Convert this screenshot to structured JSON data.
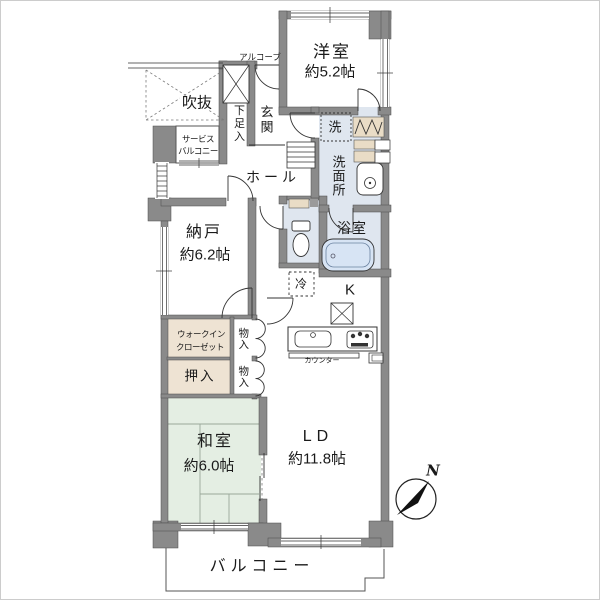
{
  "colors": {
    "wall": "#8a8a8a",
    "wet_floor": "#dfe6ef",
    "tatami": "#e4eee3",
    "closet": "#eee3d3",
    "shelf": "#e9dcc6",
    "bathtub": "#d7e4f4",
    "line": "#333333"
  },
  "labels": {
    "western_room": "洋室",
    "western_room_size": "約5.2帖",
    "alcove": "アルコーブ",
    "void": "吹抜",
    "service_balcony_line1": "サービス",
    "service_balcony_line2": "バルコニー",
    "shoe_cabinet": "下足入",
    "entrance": "玄関",
    "hall": "ホール",
    "laundry": "洗",
    "washroom": "洗面所",
    "bathroom": "浴室",
    "storage_room": "納戸",
    "storage_room_size": "約6.2帖",
    "refrigerator": "冷",
    "kitchen": "K",
    "counter": "カウンター",
    "walk_in_closet_line1": "ウォークイン",
    "walk_in_closet_line2": "クローゼット",
    "storage_upper": "物入",
    "storage_lower": "物入",
    "oshiire": "押入",
    "japanese_room": "和室",
    "japanese_room_size": "約6.0帖",
    "living_dining": "LD",
    "living_dining_size": "約11.8帖",
    "balcony": "バルコニー",
    "north": "N"
  }
}
